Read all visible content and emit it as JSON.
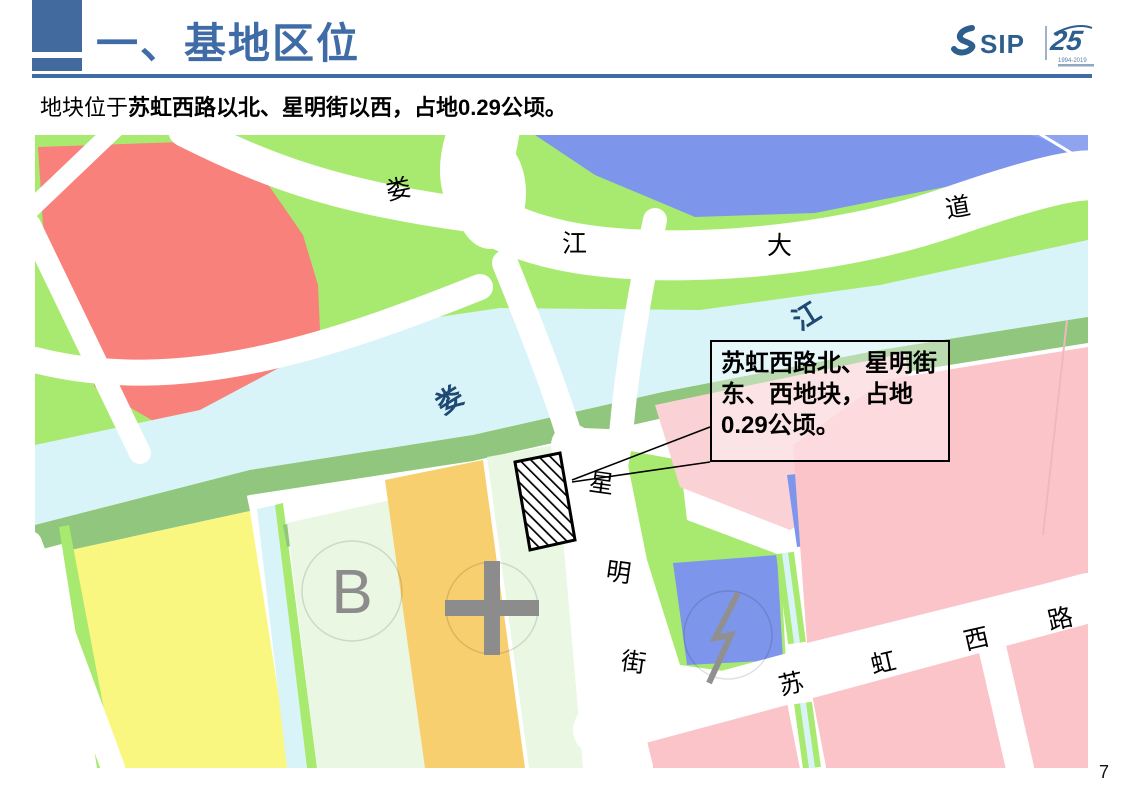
{
  "slide": {
    "title": "一、基地区位",
    "subtitle_prefix": "地块位于",
    "subtitle_bold": "苏虹西路以北、星明街以西，占地0.29公顷。",
    "page_number": "7"
  },
  "logo": {
    "sip_text": "SIP",
    "anniversary": "25",
    "years": "1994-2019"
  },
  "map": {
    "callout_text": "苏虹西路北、星明街东、西地块，占地0.29公顷。",
    "road_labels": [
      "娄",
      "江",
      "大",
      "道"
    ],
    "river_labels": [
      "娄",
      "江"
    ],
    "street_xingming": [
      "星",
      "明",
      "街"
    ],
    "road_suhong": [
      "苏",
      "虹",
      "西",
      "路"
    ],
    "markers": {
      "b_label": "B"
    },
    "colors": {
      "accent_blue": "#3F6CA6",
      "park_green": "#A8EA6F",
      "bank_green": "#90C67E",
      "water_cyan": "#D9F4F9",
      "red_block": "#F8817B",
      "pink_block": "#FAC4C8",
      "pale_pink_block": "#FAD2D5",
      "blue_block": "#7D96EB",
      "yellow_block": "#F9F77F",
      "orange_block": "#F8CF6F",
      "pale_green_block": "#EAF7E3"
    }
  }
}
